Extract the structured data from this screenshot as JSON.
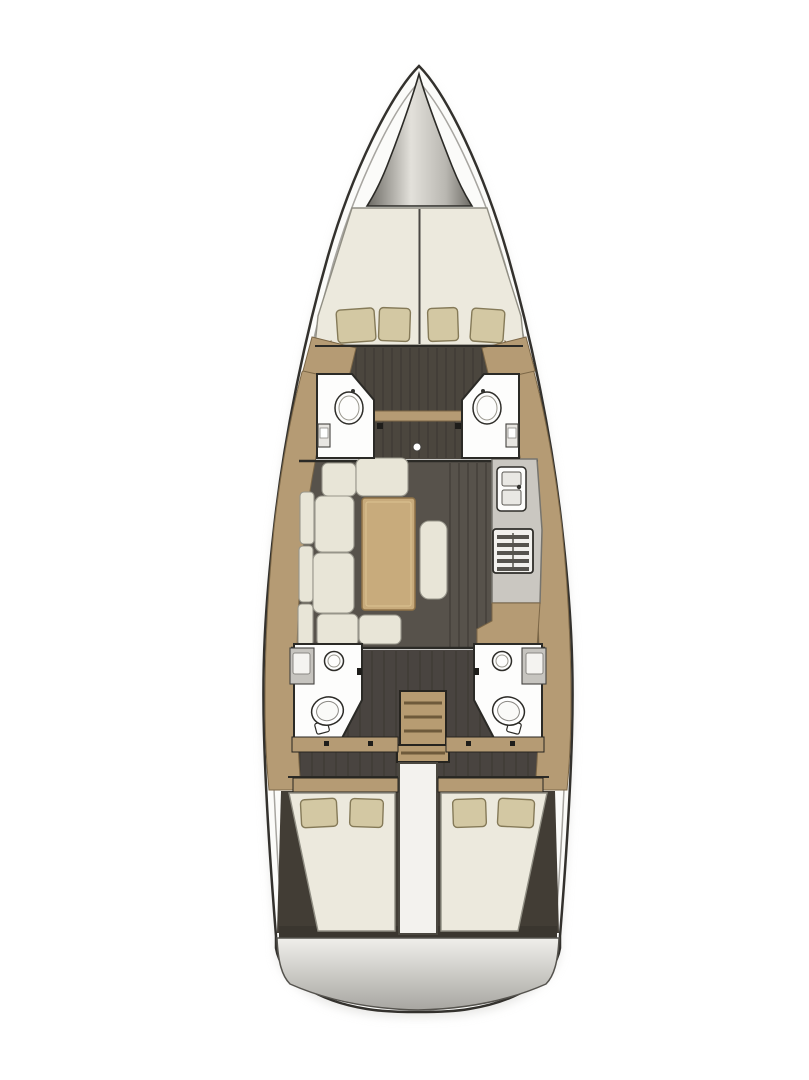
{
  "scene": {
    "type": "sailing-yacht-interior-floor-plan",
    "view": "top-down",
    "regions": {
      "bow": "anchor-locker",
      "forward_cabin": "v-berth-double-with-4-pillows",
      "forward_heads": [
        "port-forward-head-with-basin",
        "starboard-forward-head-with-basin"
      ],
      "salon": [
        "u-shaped-sofa",
        "wood-table",
        "bench-seat"
      ],
      "galley": [
        "counter",
        "double-sink",
        "stove-oven"
      ],
      "companionway": "wood-stairs-4-treads",
      "aft_heads": [
        "port-aft-head-toilet-vanity",
        "starboard-aft-head-toilet-vanity"
      ],
      "aft_cabins": [
        "port-double-berth-2-pillows",
        "starboard-double-berth-2-pillows"
      ],
      "stern": "swim-platform"
    }
  },
  "colors": {
    "background": "#ffffff",
    "shadow": "#d6d5d1",
    "hull_fill": "#fbfbf9",
    "hull_outline": "#33312d",
    "inner_line": "#a7a5a0",
    "anchor_edge": "#6b6963",
    "anchor_mid": "#b9b7b1",
    "anchor_light": "#e3e1db",
    "bulkhead": "#2b2a26",
    "wood": "#b59b74",
    "wood_edge": "#7c6747",
    "wood_light": "#c8ab7c",
    "mattress": "#ece9dd",
    "cushion": "#e8e5d7",
    "pillow": "#d3c8a3",
    "floor_fwd": "#4b463e",
    "floor_salon": "#57524b",
    "floor_aft": "#494440",
    "floor_cabin": "#423d35",
    "plank": "#3b3731",
    "white_fixture": "#fdfdfc",
    "fixture_stroke": "#2e2d29",
    "counter": "#cac7c1",
    "vanity": "#c6c4bf",
    "vanity_inner": "#f4f3f0",
    "appliance": "#f2f1ee",
    "appliance_detail": "#56544f",
    "stair": "#b79c72",
    "stair_line": "#6e5a3b",
    "divider": "#f3f2ee",
    "transom_band": "#3a362f",
    "platform_light": "#f0efeb",
    "platform_dark": "#a8a6a1",
    "dark_detail": "#1e1d1a"
  }
}
